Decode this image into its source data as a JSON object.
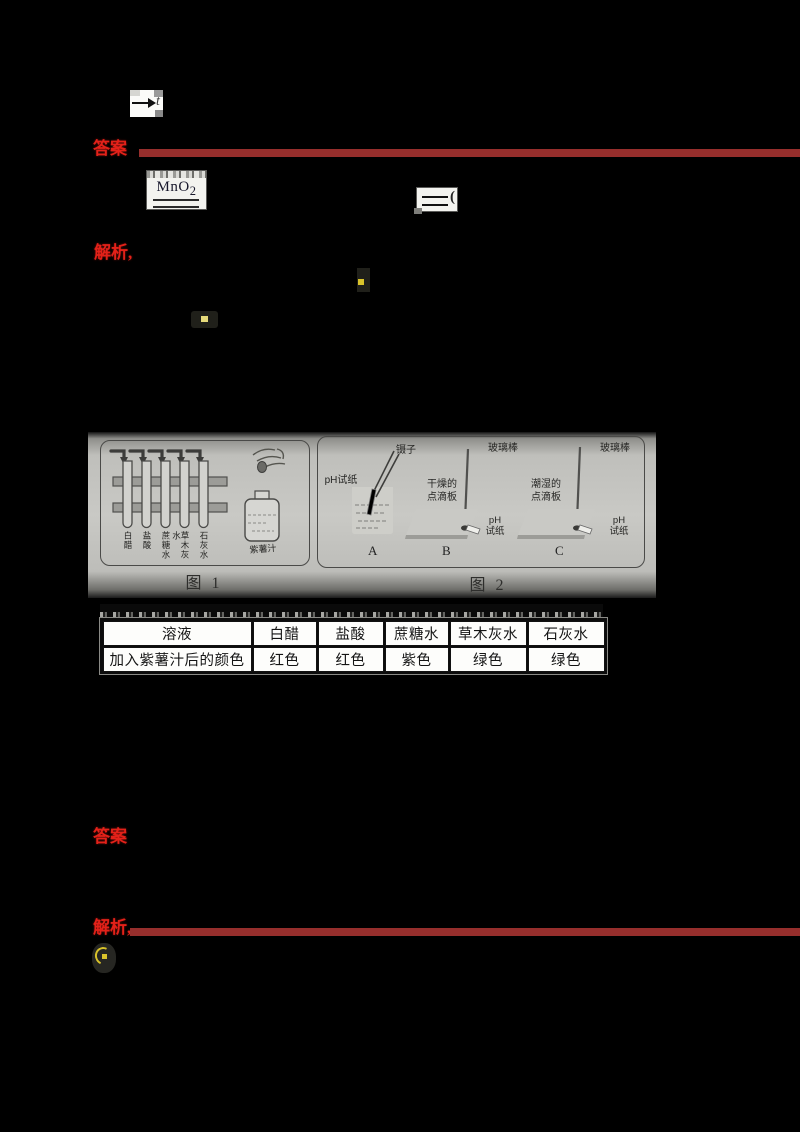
{
  "colors": {
    "page_bg": "#000000",
    "red_text": "#e32119",
    "red_bar": "#962e2c",
    "paper_gray": "#c9c9c5"
  },
  "axis_icon": {
    "label": "t"
  },
  "equation": {
    "catalyst_main": "MnO",
    "catalyst_sub": "2",
    "equals_mark": "("
  },
  "sections": [
    {
      "label": "答案"
    },
    {
      "label": "解析,"
    },
    {
      "label": "答案"
    },
    {
      "label": "解析,"
    }
  ],
  "figure": {
    "fig1": {
      "caption": "图 1",
      "tube_labels": [
        "白醋",
        "盐酸",
        "蔗糖水",
        "草木灰水",
        "石灰水"
      ],
      "bottle_label": "紫薯汁"
    },
    "fig2": {
      "caption": "图 2",
      "labels": {
        "tweezers": "镊子",
        "ph_paper_a": "pH试纸",
        "glass_rod_b": "玻璃棒",
        "glass_rod_c": "玻璃棒",
        "dry_line1": "干燥的",
        "dry_line2": "点滴板",
        "wet_line1": "潮湿的",
        "wet_line2": "点滴板",
        "ph_b_line1": "pH",
        "ph_b_line2": "试纸",
        "ph_c_line1": "pH",
        "ph_c_line2": "试纸"
      },
      "letters": [
        "A",
        "B",
        "C"
      ]
    }
  },
  "table": {
    "headers": [
      "溶液",
      "白醋",
      "盐酸",
      "蔗糖水",
      "草木灰水",
      "石灰水"
    ],
    "row_label": "加入紫薯汁后的颜色",
    "values": [
      "红色",
      "红色",
      "紫色",
      "绿色",
      "绿色"
    ]
  }
}
